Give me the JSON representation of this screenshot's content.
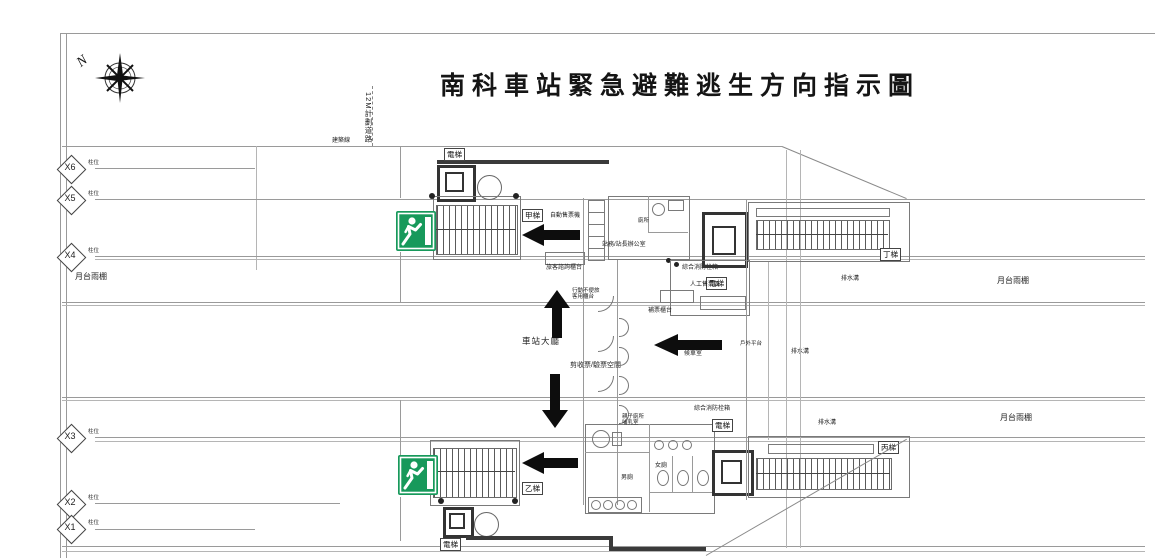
{
  "title": "南科車站緊急避難逃生方向指示圖",
  "compass_label": "N",
  "site": {
    "road": "12M計劃道路",
    "building_line": "建築線"
  },
  "grid_markers": [
    {
      "id": "X6",
      "note": "柱位"
    },
    {
      "id": "X5",
      "note": "柱位"
    },
    {
      "id": "X4",
      "note": "柱位"
    },
    {
      "id": "X3",
      "note": "柱位"
    },
    {
      "id": "X2",
      "note": "柱位"
    },
    {
      "id": "X1",
      "note": "柱位"
    }
  ],
  "labels": {
    "elevator": "電梯",
    "stair_a": "甲梯",
    "stair_b": "乙梯",
    "stair_c": "丙梯",
    "stair_d": "丁梯",
    "hall": "車站大廳",
    "gate_space": "剪收票/驗票空間",
    "ticket_machines": "自動售票機",
    "info_counter": "旅客諮詢櫃台",
    "accessible_counter": "行動不便旅客用櫃台",
    "station_office": "站務/站長辦公室",
    "office_toilet": "廁所",
    "manual_ticketing": "人工售票區",
    "fare_adjustment": "補票櫃台",
    "waiting_room": "候車室",
    "fire_hydrant": "綜合消防栓箱",
    "family_toilet": "親子廁所",
    "nursing_room": "哺乳室",
    "womens_toilet": "女廁",
    "mens_toilet": "男廁",
    "outdoor_platform": "戶外平台",
    "platform_canopy": "月台雨棚",
    "drainage": "排水溝"
  },
  "evacuation_arrows": [
    {
      "direction": "left",
      "location": "upper-concourse"
    },
    {
      "direction": "up",
      "location": "central-hall-north"
    },
    {
      "direction": "down",
      "location": "central-hall-south"
    },
    {
      "direction": "left",
      "location": "waiting-room"
    },
    {
      "direction": "left",
      "location": "lower-concourse"
    }
  ],
  "exit_signs": [
    {
      "location": "stair-a-west"
    },
    {
      "location": "stair-b-west"
    }
  ],
  "colors": {
    "exit_green": "#17995b",
    "arrow": "#0d0d0d",
    "wall": "#3a3a3a",
    "line": "#9a9a9a"
  }
}
